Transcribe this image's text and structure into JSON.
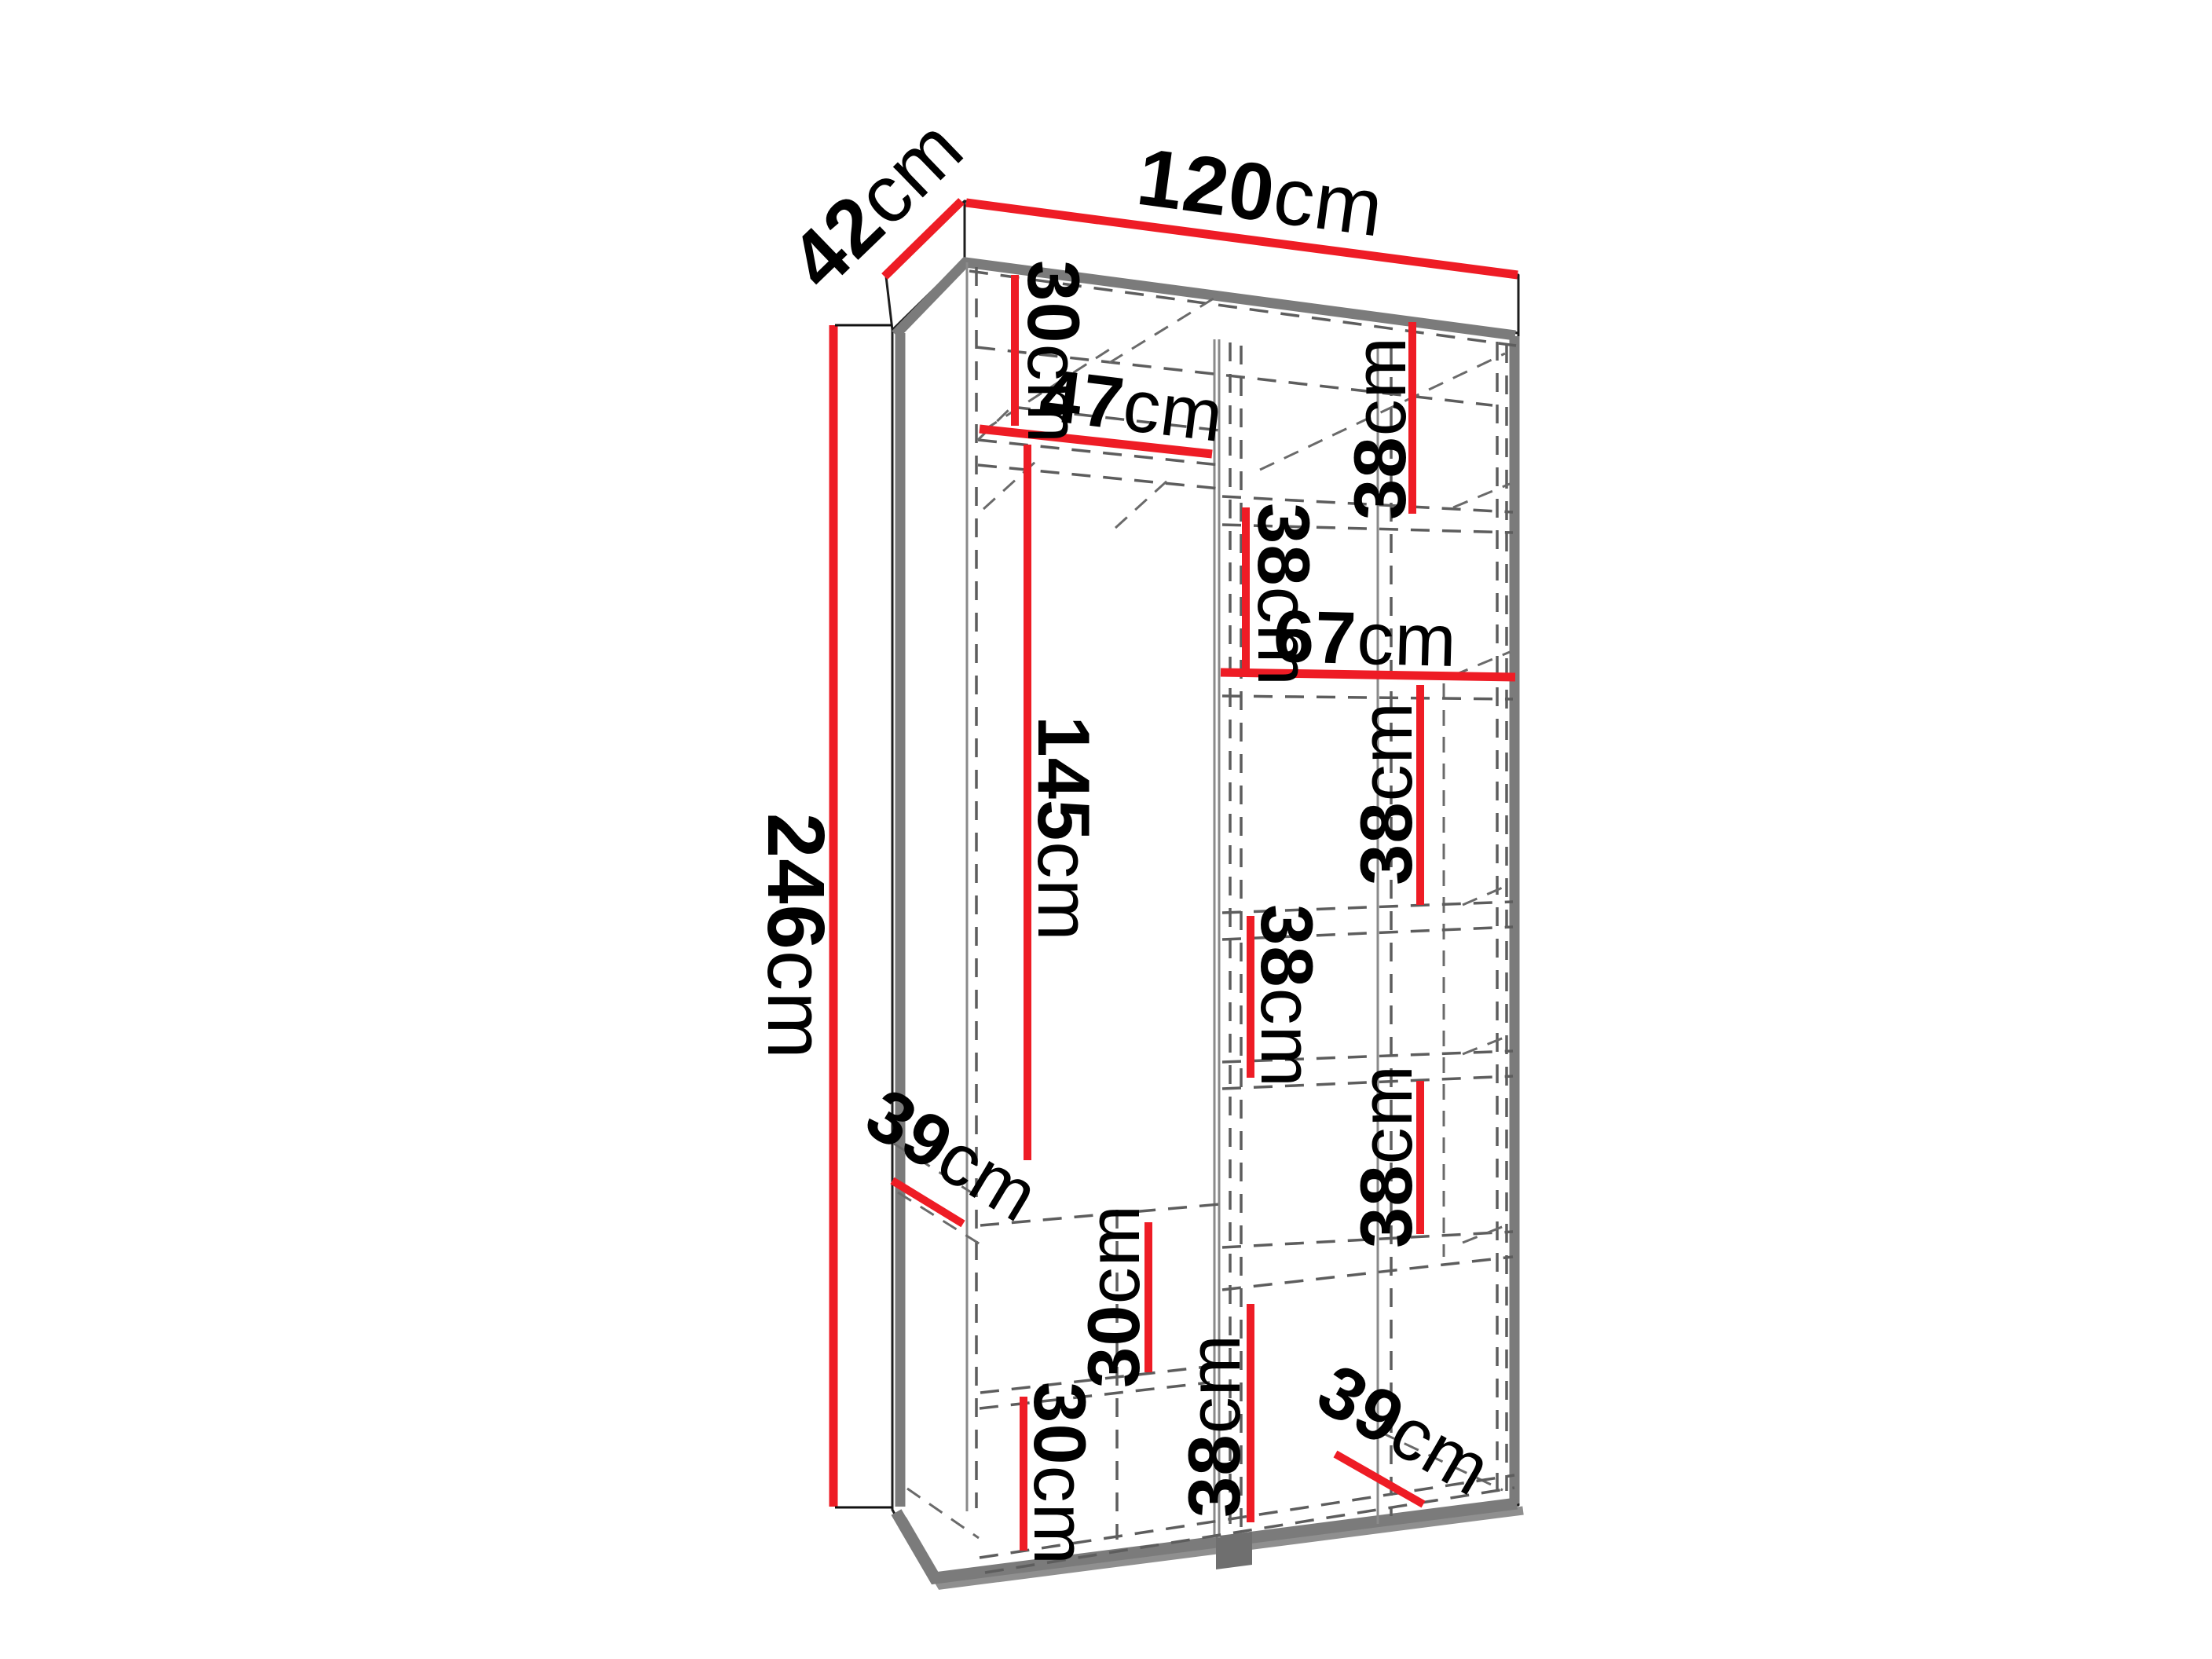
{
  "diagram": {
    "kind": "furniture-dimension-diagram",
    "subject": "wardrobe interior dimensions",
    "unit": "cm",
    "colors": {
      "dimension_line": "#ee1c25",
      "body_outline": "#1d1d1d",
      "edge_accent": "#7b7b7b",
      "hidden_line": "#5d5d5d",
      "background": "#ffffff"
    },
    "overall_dimensions": {
      "width": {
        "number": "120",
        "unit": "cm"
      },
      "depth": {
        "number": "42",
        "unit": "cm"
      },
      "height": {
        "number": "246",
        "unit": "cm"
      }
    },
    "measurements": {
      "m42": {
        "number": "42",
        "unit": "cm"
      },
      "m120": {
        "number": "120",
        "unit": "cm"
      },
      "m246": {
        "number": "246",
        "unit": "cm"
      },
      "c30top": {
        "number": "30",
        "unit": "cm"
      },
      "w47": {
        "number": "47",
        "unit": "cm"
      },
      "r38a": {
        "number": "38",
        "unit": "cm"
      },
      "r38b": {
        "number": "38",
        "unit": "cm"
      },
      "w67": {
        "number": "67",
        "unit": "cm"
      },
      "r38c": {
        "number": "38",
        "unit": "cm"
      },
      "h145": {
        "number": "145",
        "unit": "cm"
      },
      "r38d": {
        "number": "38",
        "unit": "cm"
      },
      "d39a": {
        "number": "39",
        "unit": "cm"
      },
      "r38e": {
        "number": "38",
        "unit": "cm"
      },
      "c30u": {
        "number": "30",
        "unit": "cm"
      },
      "c30l": {
        "number": "30",
        "unit": "cm"
      },
      "r38f": {
        "number": "38",
        "unit": "cm"
      },
      "d39b": {
        "number": "39",
        "unit": "cm"
      }
    }
  }
}
